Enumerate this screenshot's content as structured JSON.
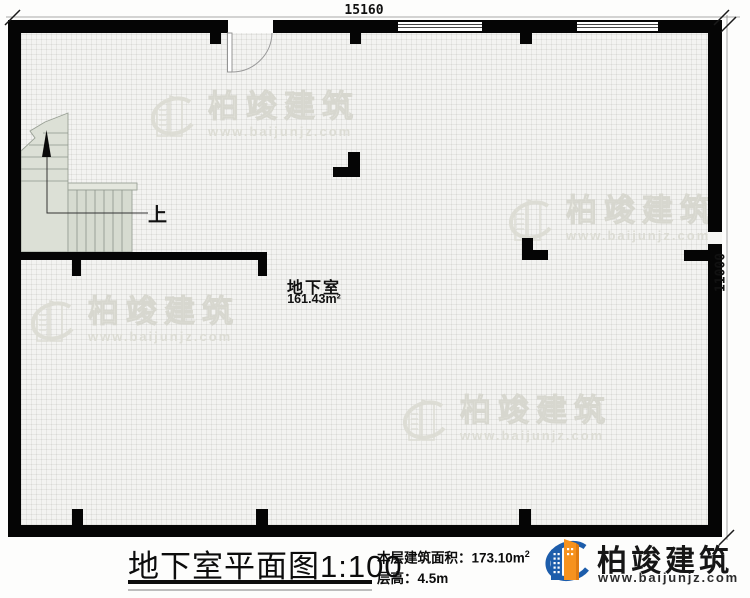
{
  "plan": {
    "dim_top": "15160",
    "dim_right": "11000",
    "room_name": "地下室",
    "room_area": "161.43m²",
    "stairs_up_label": "上"
  },
  "watermark": {
    "brand": "柏竣建筑",
    "url": "www.baijunjz.com"
  },
  "footer": {
    "title": "地下室平面图",
    "scale": "1:100",
    "area_label": "本层建筑面积：",
    "area_value": "173.10m",
    "area_sup": "2",
    "height_label": "层高：",
    "height_value": "4.5m",
    "brand": "柏竣建筑",
    "brand_url": "www.baijunjz.com"
  },
  "colors": {
    "wall": "#050505",
    "floor": "#f3f3f1",
    "stair_fill": "#dce0d6",
    "brand_blue": "#1d5dab",
    "brand_orange": "#f6921e",
    "watermark_gray": "#dcdcd4"
  }
}
